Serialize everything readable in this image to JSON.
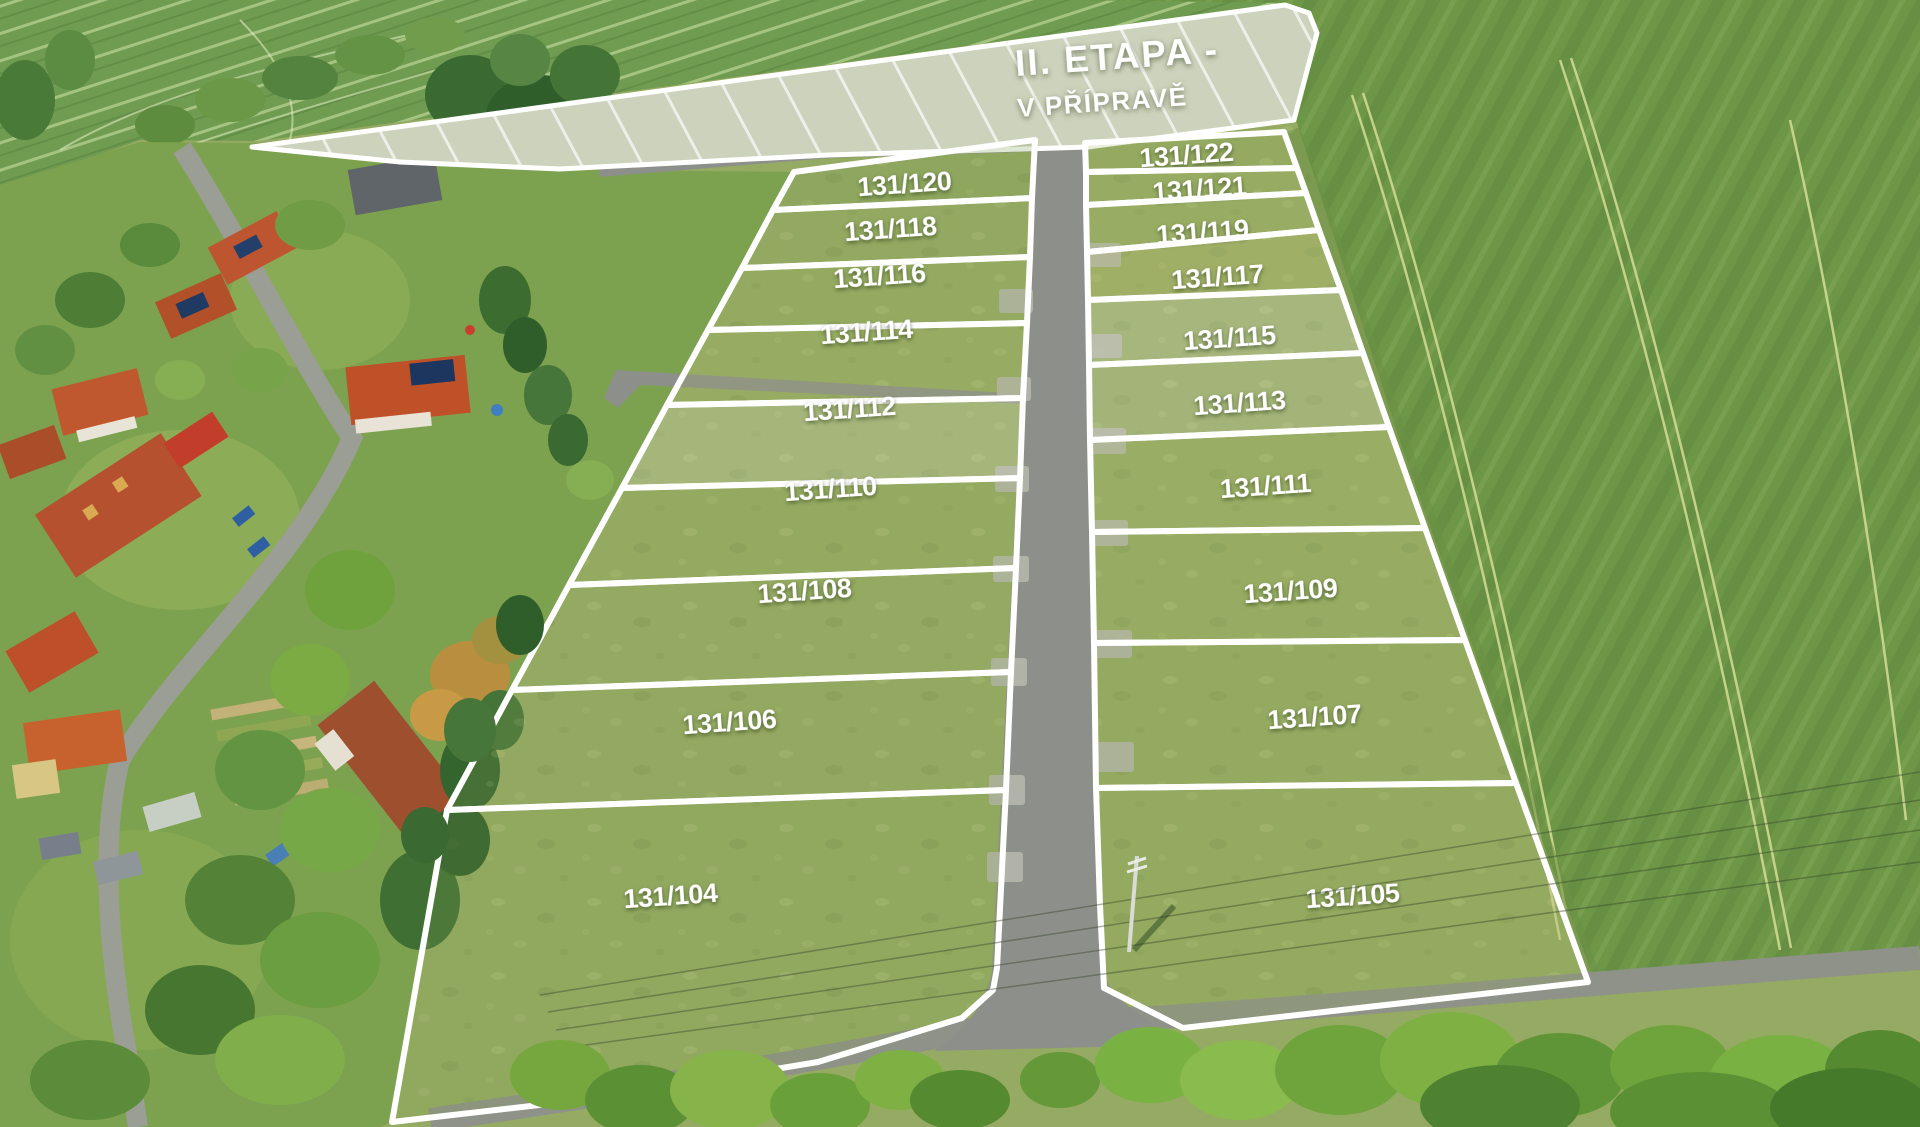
{
  "scene": {
    "phase_title": "II. ETAPA -",
    "phase_subtitle": "V PŘÍPRAVĚ"
  },
  "map_data": {
    "type": "plot-map",
    "description": "Aerial view of a residential land development with numbered parcels outlined in white, a new central road, and a hatched area marking phase II under preparation",
    "line_color": "#ffffff",
    "road_color": "#8d908a",
    "plots": [
      {
        "label": "131/120",
        "side": "left",
        "points": "794,172 1035,140 1032,198 773,210",
        "lx": 905,
        "ly": 193,
        "tint": "rgba(125,155,82,0.25)"
      },
      {
        "label": "131/118",
        "side": "left",
        "points": "773,210 1032,198 1030,257 742,268",
        "lx": 891,
        "ly": 238,
        "tint": "rgba(140,165,90,0.22)"
      },
      {
        "label": "131/116",
        "side": "left",
        "points": "742,268 1030,257 1027,323 708,330",
        "lx": 880,
        "ly": 285,
        "tint": "rgba(150,170,95,0.20)"
      },
      {
        "label": "131/114",
        "side": "left",
        "points": "708,330 1027,323 1023,398 667,405",
        "lx": 867,
        "ly": 341,
        "tint": "rgba(160,175,100,0.20)"
      },
      {
        "label": "131/112",
        "side": "left",
        "points": "667,405 1023,398 1020,478 622,488",
        "lx": 850,
        "ly": 418,
        "tint": "rgba(205,208,180,0.30)"
      },
      {
        "label": "131/110",
        "side": "left",
        "points": "622,488 1020,478 1016,568 569,585",
        "lx": 831,
        "ly": 498,
        "tint": "rgba(150,170,95,0.18)"
      },
      {
        "label": "131/108",
        "side": "left",
        "points": "569,585 1016,568 1011,672 512,690",
        "lx": 805,
        "ly": 600,
        "tint": "rgba(145,168,92,0.18)"
      },
      {
        "label": "131/106",
        "side": "left",
        "points": "512,690 1011,672 1006,790 447,810",
        "lx": 730,
        "ly": 731,
        "tint": "rgba(138,162,88,0.20)"
      },
      {
        "label": "131/104",
        "side": "left",
        "points": "447,810 1006,790 997,968 993,990 962,1018 818,1062 600,1098 392,1122",
        "lx": 671,
        "ly": 905,
        "tint": "rgba(130,158,85,0.20)"
      },
      {
        "label": "131/122",
        "side": "right",
        "points": "1085,143 1284,132 1297,168 1086,172",
        "lx": 1187,
        "ly": 164,
        "tint": "rgba(150,172,95,0.22)"
      },
      {
        "label": "131/121",
        "side": "right",
        "points": "1086,172 1297,168 1306,193 1086,205",
        "lx": 1200,
        "ly": 198,
        "tint": "rgba(158,178,100,0.20)"
      },
      {
        "label": "131/119",
        "side": "right",
        "points": "1086,205 1306,193 1319,230 1087,252",
        "lx": 1203,
        "ly": 241,
        "tint": "rgba(165,182,105,0.22)"
      },
      {
        "label": "131/117",
        "side": "right",
        "points": "1087,252 1319,230 1341,290 1088,300",
        "lx": 1218,
        "ly": 286,
        "tint": "rgba(185,192,115,0.28)"
      },
      {
        "label": "131/115",
        "side": "right",
        "points": "1088,300 1341,290 1363,353 1089,365",
        "lx": 1230,
        "ly": 347,
        "tint": "rgba(210,212,185,0.30)"
      },
      {
        "label": "131/113",
        "side": "right",
        "points": "1089,365 1363,353 1389,427 1090,440",
        "lx": 1240,
        "ly": 412,
        "tint": "rgba(205,210,180,0.28)"
      },
      {
        "label": "131/111",
        "side": "right",
        "points": "1090,440 1389,427 1425,528 1092,532",
        "lx": 1266,
        "ly": 495,
        "tint": "rgba(170,185,110,0.22)"
      },
      {
        "label": "131/109",
        "side": "right",
        "points": "1092,532 1425,528 1465,640 1094,643",
        "lx": 1291,
        "ly": 600,
        "tint": "rgba(160,178,100,0.20)"
      },
      {
        "label": "131/107",
        "side": "right",
        "points": "1094,643 1465,640 1516,783 1096,788",
        "lx": 1315,
        "ly": 726,
        "tint": "rgba(152,172,96,0.20)"
      },
      {
        "label": "131/105",
        "side": "right",
        "points": "1096,788 1516,783 1588,982 1183,1028 1104,988 1100,905",
        "lx": 1353,
        "ly": 905,
        "tint": "rgba(145,168,92,0.20)"
      }
    ]
  }
}
